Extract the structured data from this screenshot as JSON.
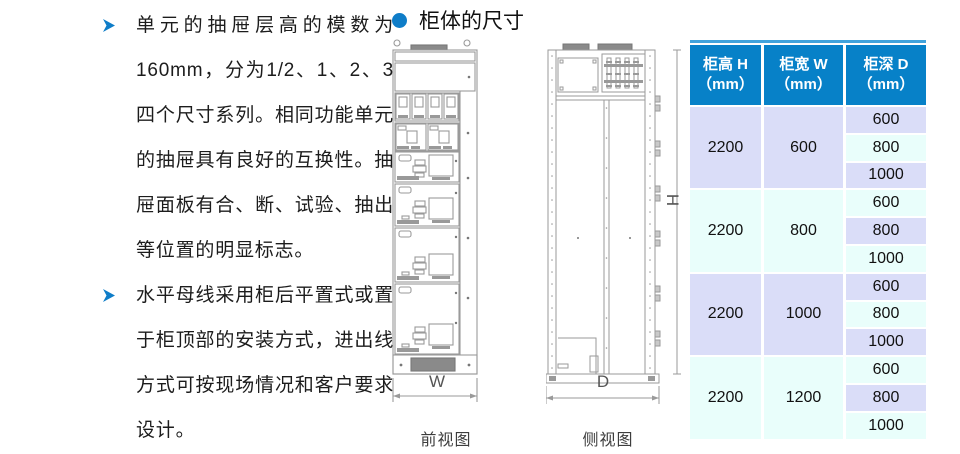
{
  "left_panel": {
    "items": [
      {
        "text": "单元的抽屉层高的模数为160mm，分为1/2、1、2、3四个尺寸系列。相同功能单元的抽屉具有良好的互换性。抽屉面板有合、断、试验、抽出等位置的明显标志。"
      },
      {
        "text": "水平母线采用柜后平置式或置于柜顶部的安装方式，进出线方式可按现场情况和客户要求设计。"
      }
    ]
  },
  "section": {
    "title": "柜体的尺寸"
  },
  "drawings": {
    "front": {
      "caption": "前视图",
      "width_label": "W"
    },
    "side": {
      "caption": "侧视图",
      "height_label": "H",
      "depth_label": "D"
    }
  },
  "table": {
    "headers": [
      {
        "label": "柜高 H",
        "unit": "（mm）"
      },
      {
        "label": "柜宽 W",
        "unit": "（mm）"
      },
      {
        "label": "柜深 D",
        "unit": "（mm）"
      }
    ],
    "groups": [
      {
        "height": "2200",
        "width": "600",
        "depths": [
          "600",
          "800",
          "1000"
        ]
      },
      {
        "height": "2200",
        "width": "800",
        "depths": [
          "600",
          "800",
          "1000"
        ]
      },
      {
        "height": "2200",
        "width": "1000",
        "depths": [
          "600",
          "800",
          "1000"
        ]
      },
      {
        "height": "2200",
        "width": "1200",
        "depths": [
          "600",
          "800",
          "1000"
        ]
      }
    ],
    "colors": {
      "header_bg": "#0781C8",
      "header_text": "#ffffff",
      "row_lavender": "#DADDF8",
      "row_cyan": "#E9FEFB",
      "top_accent": "#41a3dc",
      "bullet_blue": "#0f7dc8"
    }
  }
}
